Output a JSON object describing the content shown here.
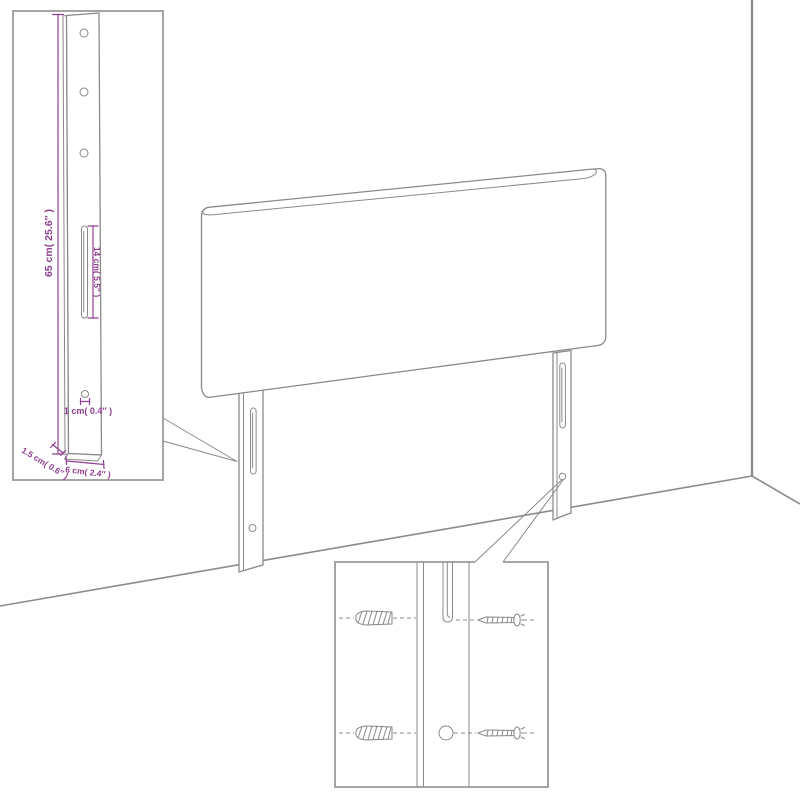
{
  "diagram": {
    "kind": "furniture assembly illustration",
    "subject": "headboard with two mounting legs shown against a wall corner",
    "insets": {
      "leg_detail": "close-up of mounting leg with dimensions",
      "hardware_detail": "close-up of leg slot and hole with wall anchors and screws"
    }
  },
  "colors": {
    "background": "#ffffff",
    "line_gray": "#8a8a8a",
    "dimension_purple": "#8f3f8f"
  },
  "leg_detail_inset": {
    "dim_height": "65 cm( 25.6″ )",
    "dim_slot": "14 cm( 5.5″ )",
    "dim_hole": "1 cm( 0.4″ )",
    "dim_depth": "1.5 cm( 0.6″ )",
    "dim_width": "6 cm( 2.4″ )"
  },
  "hardware_detail_inset": {
    "parts": [
      "wall-anchor",
      "screw"
    ]
  }
}
